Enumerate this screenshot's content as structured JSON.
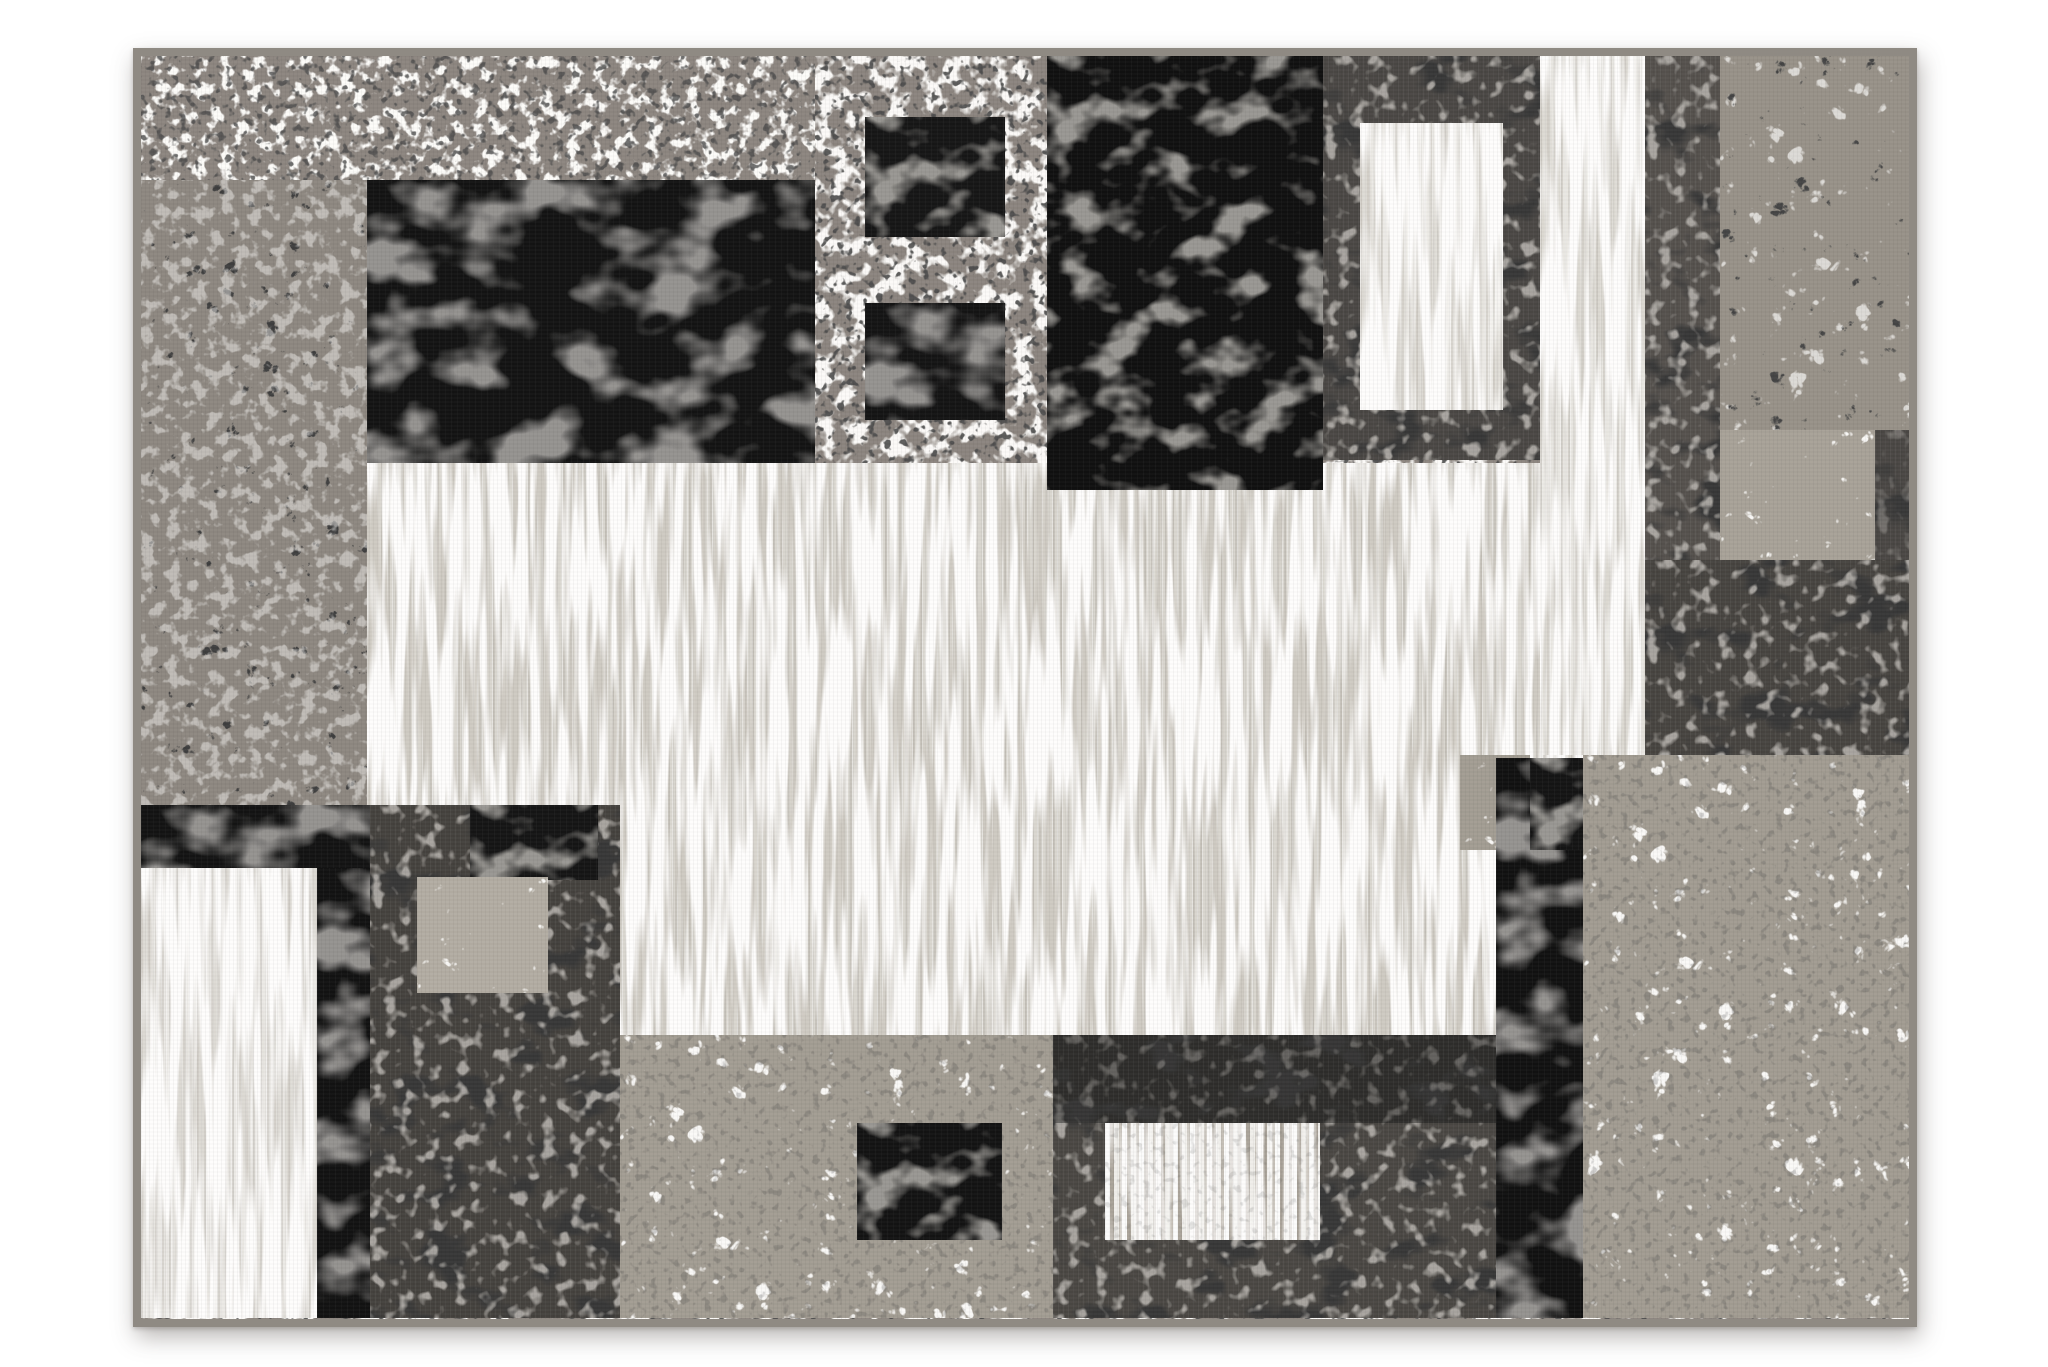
{
  "scene": {
    "kind": "product-photo",
    "subject": "modern geometric patchwork area rug, distressed black, gray and white squares",
    "background_color": "#ffffff",
    "orientation": "landscape"
  },
  "palette": {
    "binding_gray": "#8f8a83",
    "base_gray": "#8d8680",
    "crackle_gray": "#8e8881",
    "black": "#131313",
    "dark_gray": "#4a4744",
    "near_black": "#2e2d2b",
    "center_light": "#d9d6cf",
    "bright_white": "#eceae6",
    "marble_gray": "#a29c92",
    "marble_light": "#b3ada3"
  },
  "rug": {
    "x": 133,
    "y": 48,
    "w": 1784,
    "h": 1279,
    "binding_width": 8
  },
  "blocks": [
    {
      "name": "rug-block-base-field",
      "x": 141,
      "y": 56,
      "w": 1768,
      "h": 1263,
      "fill": "#8d8680",
      "kind": "speckle"
    },
    {
      "name": "rug-block-center-light",
      "x": 367,
      "y": 463,
      "w": 1278,
      "h": 572,
      "fill": "#d9d6cf",
      "kind": "light"
    },
    {
      "name": "rug-block-top-band",
      "x": 141,
      "y": 56,
      "w": 906,
      "h": 124,
      "fill": "#8d8680",
      "kind": "speckle2"
    },
    {
      "name": "rug-block-top-field",
      "x": 815,
      "y": 56,
      "w": 232,
      "h": 407,
      "fill": "#8c857f",
      "kind": "speckle"
    },
    {
      "name": "rug-block-left-crackle-column",
      "x": 141,
      "y": 180,
      "w": 226,
      "h": 625,
      "fill": "#8e8881",
      "kind": "crackle"
    },
    {
      "name": "rug-block-black-main",
      "x": 367,
      "y": 180,
      "w": 448,
      "h": 283,
      "fill": "#131313",
      "kind": "black"
    },
    {
      "name": "rug-block-small-black-square-1",
      "x": 865,
      "y": 117,
      "w": 140,
      "h": 120,
      "fill": "#161616",
      "kind": "black2"
    },
    {
      "name": "rug-block-small-black-square-2",
      "x": 865,
      "y": 303,
      "w": 140,
      "h": 117,
      "fill": "#141414",
      "kind": "black"
    },
    {
      "name": "rug-block-black-column-top",
      "x": 1047,
      "y": 56,
      "w": 276,
      "h": 434,
      "fill": "#101010",
      "kind": "black2"
    },
    {
      "name": "rug-block-dark-frame",
      "x": 1323,
      "y": 56,
      "w": 217,
      "h": 404,
      "fill": "#4a4744",
      "kind": "dark"
    },
    {
      "name": "rug-block-white-framed-rect",
      "x": 1360,
      "y": 123,
      "w": 143,
      "h": 287,
      "fill": "#eceae5",
      "kind": "bright"
    },
    {
      "name": "rug-block-white-stripe-column",
      "x": 1540,
      "y": 56,
      "w": 105,
      "h": 699,
      "fill": "#e9e7e2",
      "kind": "bright"
    },
    {
      "name": "rug-block-dark-stripe-column",
      "x": 1645,
      "y": 56,
      "w": 75,
      "h": 699,
      "fill": "#55514d",
      "kind": "dark"
    },
    {
      "name": "rug-block-marble-column-topright",
      "x": 1720,
      "y": 56,
      "w": 191,
      "h": 374,
      "fill": "#989289",
      "kind": "marbledark"
    },
    {
      "name": "rug-block-marble-square-topright",
      "x": 1720,
      "y": 430,
      "w": 155,
      "h": 130,
      "fill": "#a8a298",
      "kind": "marble2"
    },
    {
      "name": "rug-block-edge-strip-right",
      "x": 1875,
      "y": 430,
      "w": 36,
      "h": 325,
      "fill": "#4a4744",
      "kind": "darker"
    },
    {
      "name": "rug-block-dark-right",
      "x": 1645,
      "y": 560,
      "w": 266,
      "h": 195,
      "fill": "#474440",
      "kind": "dark"
    },
    {
      "name": "rug-block-black-band-left",
      "x": 141,
      "y": 805,
      "w": 229,
      "h": 63,
      "fill": "#131313",
      "kind": "black"
    },
    {
      "name": "rug-block-dark-bottomleft",
      "x": 370,
      "y": 805,
      "w": 250,
      "h": 513,
      "fill": "#45423e",
      "kind": "dark"
    },
    {
      "name": "rug-block-black-patch-bottomleft",
      "x": 470,
      "y": 805,
      "w": 128,
      "h": 75,
      "fill": "#151515",
      "kind": "black2"
    },
    {
      "name": "rug-block-light-inset-bottomleft",
      "x": 417,
      "y": 877,
      "w": 131,
      "h": 116,
      "fill": "#b3ada3",
      "kind": "marble2"
    },
    {
      "name": "rug-block-white-column-left",
      "x": 141,
      "y": 868,
      "w": 176,
      "h": 450,
      "fill": "#eceae6",
      "kind": "bright"
    },
    {
      "name": "rug-block-black-column-bottomleft",
      "x": 317,
      "y": 868,
      "w": 53,
      "h": 450,
      "fill": "#121212",
      "kind": "black"
    },
    {
      "name": "rug-block-marble-band-bottom",
      "x": 620,
      "y": 1035,
      "w": 433,
      "h": 283,
      "fill": "#a39d93",
      "kind": "marble"
    },
    {
      "name": "rug-block-black-square-bottom",
      "x": 857,
      "y": 1123,
      "w": 145,
      "h": 117,
      "fill": "#131313",
      "kind": "black2"
    },
    {
      "name": "rug-block-dark-bottomcenter",
      "x": 1053,
      "y": 1035,
      "w": 443,
      "h": 283,
      "fill": "#4a4743",
      "kind": "dark"
    },
    {
      "name": "rug-block-dark-strip-bottomcenter",
      "x": 1053,
      "y": 1035,
      "w": 443,
      "h": 88,
      "fill": "#2e2d2b",
      "kind": "darker"
    },
    {
      "name": "rug-block-white-striped-inset",
      "x": 1105,
      "y": 1123,
      "w": 215,
      "h": 117,
      "fill": "#eceae5",
      "kind": "striped"
    },
    {
      "name": "rug-block-marble-patch-right",
      "x": 1460,
      "y": 755,
      "w": 70,
      "h": 95,
      "fill": "#a39d93",
      "kind": "marble2"
    },
    {
      "name": "rug-block-black-column-right",
      "x": 1496,
      "y": 758,
      "w": 87,
      "h": 560,
      "fill": "#111111",
      "kind": "black"
    },
    {
      "name": "rug-block-black-square-right",
      "x": 1530,
      "y": 758,
      "w": 115,
      "h": 92,
      "fill": "#141414",
      "kind": "black2"
    },
    {
      "name": "rug-block-marble-bottomright",
      "x": 1583,
      "y": 755,
      "w": 328,
      "h": 563,
      "fill": "#a29c92",
      "kind": "marble"
    }
  ]
}
